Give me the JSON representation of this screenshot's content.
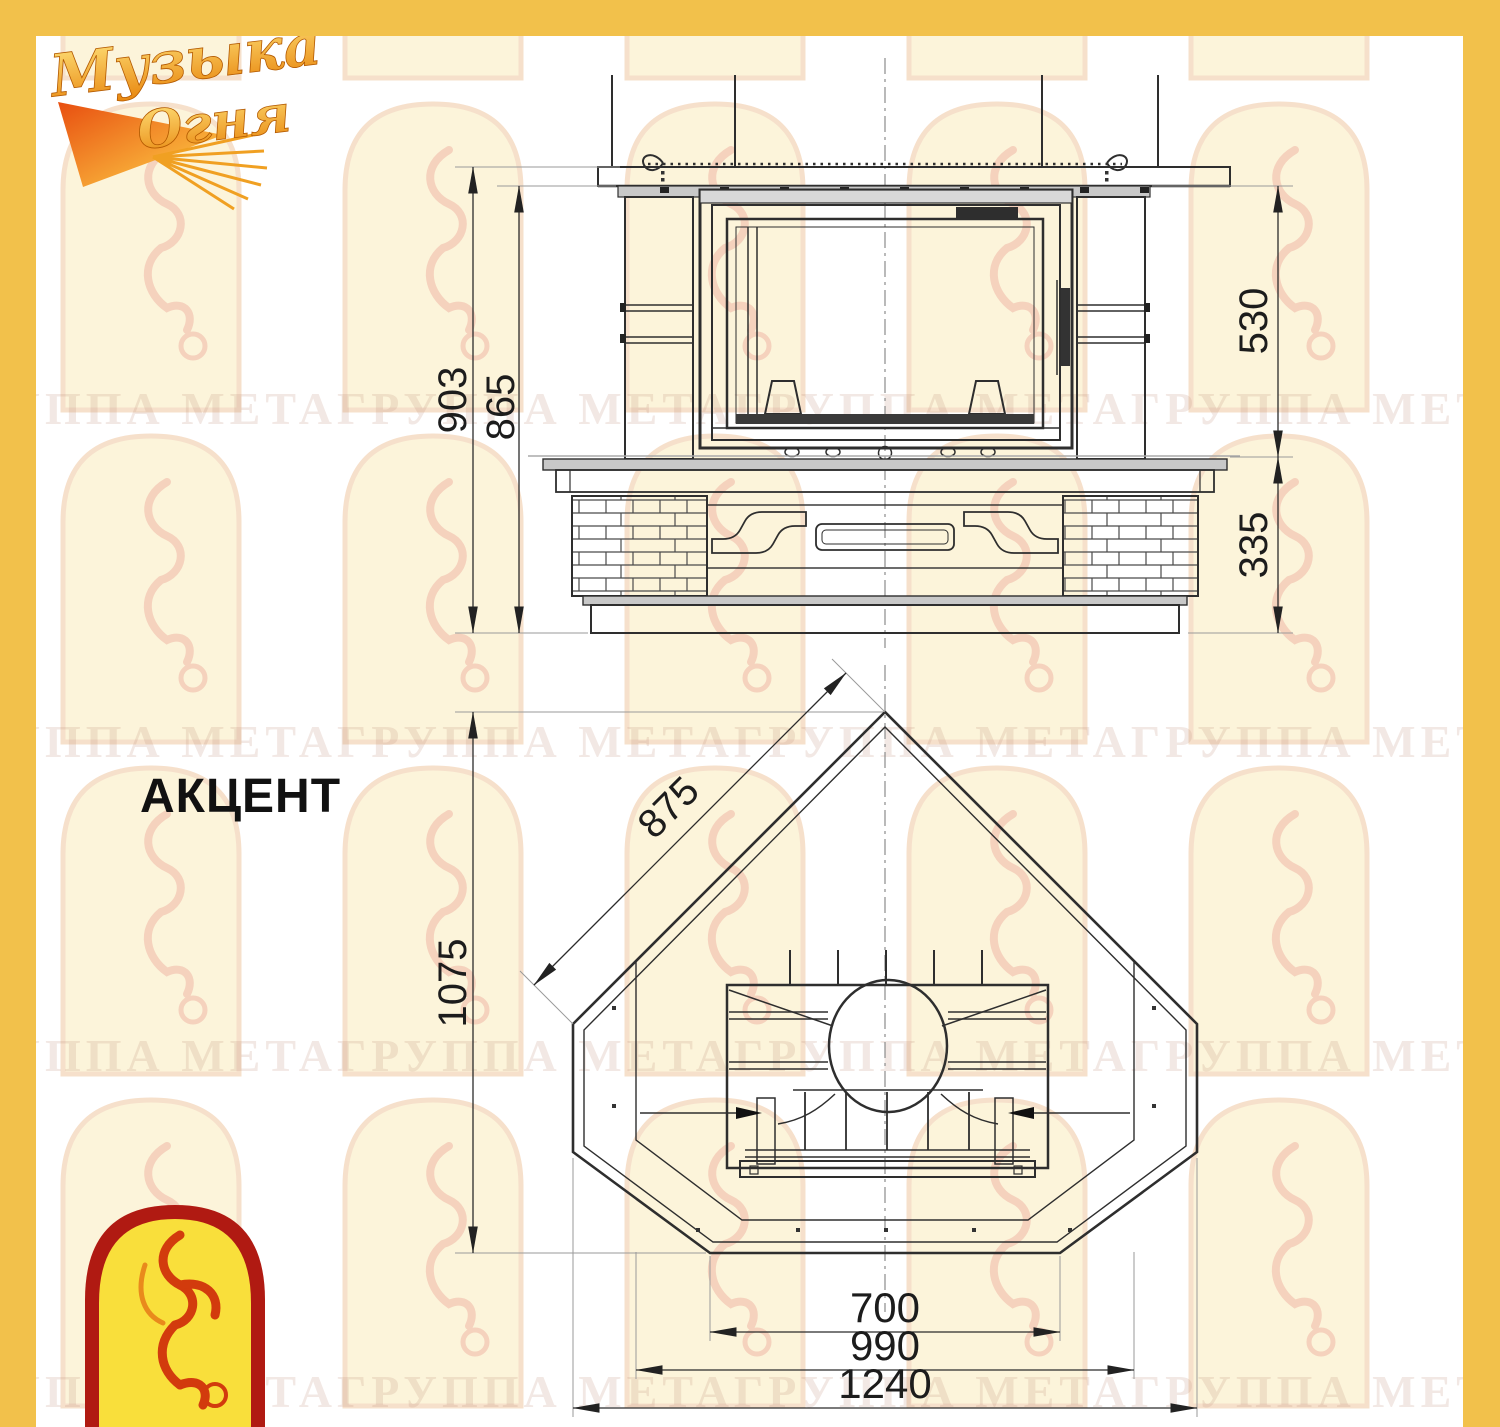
{
  "page": {
    "model_label": "АКЦЕНТ"
  },
  "branding": {
    "top_logo": {
      "line1": "Музыка",
      "line2": "Огня"
    },
    "watermark_row": "ГРУППА МЕТАГРУППА МЕТАГРУППА МЕТАГРУППА МЕТАГРУППА МЕТА",
    "colors": {
      "frame_yellow": "#F2C14B",
      "logo_red": "#B01A12",
      "logo_yellow": "#F9DF3B",
      "line_dark": "#2e2e2e"
    }
  },
  "views": {
    "front": {
      "name": "front-elevation",
      "dimensions": [
        {
          "id": "total_height",
          "value": "903",
          "unit": "mm",
          "orientation": "vertical"
        },
        {
          "id": "height_under_shelf",
          "value": "865",
          "unit": "mm",
          "orientation": "vertical"
        },
        {
          "id": "portal_height",
          "value": "530",
          "unit": "mm",
          "orientation": "vertical"
        },
        {
          "id": "base_height",
          "value": "335",
          "unit": "mm",
          "orientation": "vertical"
        }
      ]
    },
    "plan": {
      "name": "top-plan",
      "dimensions": [
        {
          "id": "facade_width",
          "value": "875",
          "unit": "mm",
          "orientation": "diagonal"
        },
        {
          "id": "depth",
          "value": "1075",
          "unit": "mm",
          "orientation": "vertical"
        },
        {
          "id": "front_edge_width",
          "value": "700",
          "unit": "mm",
          "orientation": "horizontal"
        },
        {
          "id": "hearth_width",
          "value": "990",
          "unit": "mm",
          "orientation": "horizontal"
        },
        {
          "id": "overall_width",
          "value": "1240",
          "unit": "mm",
          "orientation": "horizontal"
        }
      ]
    }
  }
}
